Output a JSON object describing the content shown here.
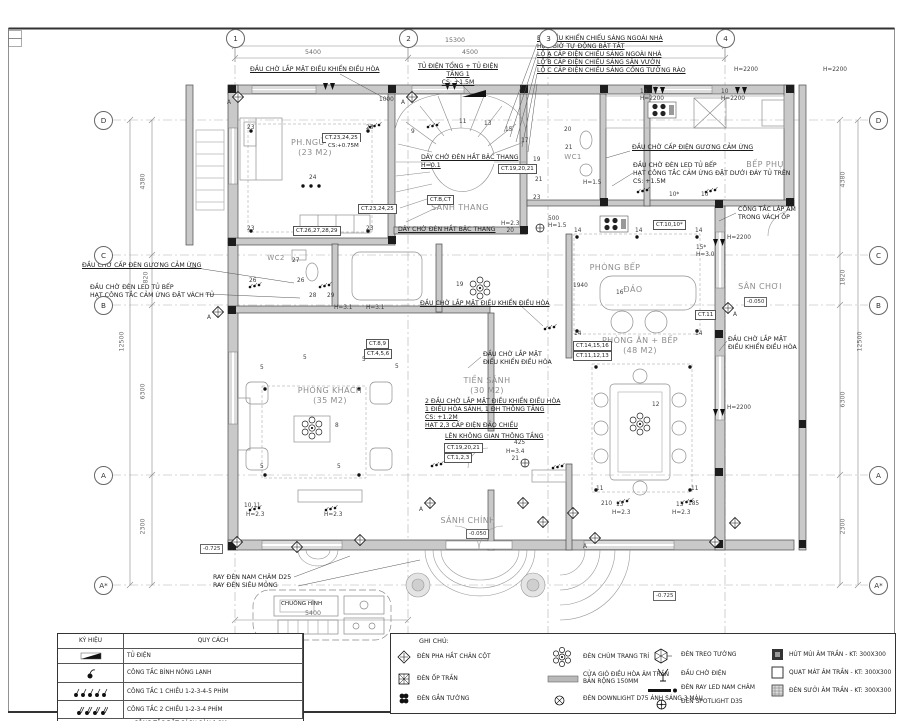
{
  "grid": {
    "top": [
      "1",
      "2",
      "3",
      "4"
    ],
    "bottom": [
      "1"
    ],
    "left": [
      "D",
      "C",
      "B",
      "A",
      "A*"
    ],
    "right": [
      "D",
      "C",
      "B",
      "A",
      "A*"
    ]
  },
  "dims": {
    "top_total": "15300",
    "top_segs": [
      "5400",
      "4500"
    ],
    "bottom": "5400",
    "left": [
      "4380",
      "820",
      "12500",
      "6300",
      "2300"
    ],
    "right": [
      "4380",
      "1820",
      "12500",
      "6300",
      "2300"
    ]
  },
  "rooms": {
    "bedroom": "PH.NGỦ-01\n(23 M2)",
    "stair_hall": "SẢNH THANG",
    "wc1": "WC1",
    "wc2": "WC2",
    "kitchen_aux": "BẾP PHỤ",
    "kitchen": "PHÒNG BẾP",
    "island": "ĐẢO",
    "playground": "SÂN CHƠI",
    "dining": "PHÒNG ĂN + BẾP\n(48 M2)",
    "living": "PHÒNG KHÁCH\n(35 M2)",
    "foyer": "TIỀN SẢNH\n(30 M2)",
    "main_hall": "SẢNH CHÍNH"
  },
  "callouts": {
    "ac_top": "ĐẦU CHỜ LẮP MẶT ĐIỀU KHIỂN ĐIỀU HÒA",
    "panel": "TỦ ĐIỆN TỔNG + TỦ ĐIỆN TẦNG 1\nCS: +1.5M",
    "lighting_ctrl": "BỘ ĐIỀU KHIỂN CHIẾU SÁNG NGOÀI NHÀ\nHẸN GIỜ TỰ ĐỘNG BẬT TẮT\nLỘ A CẤP ĐIỆN CHIẾU SÁNG NGOÀI NHÀ\nLỘ B CẤP ĐIỆN CHIẾU SÁNG SÂN VƯỜN\nLỘ C CẤP ĐIỆN CHIẾU SÁNG CỔNG TƯỜNG RÀO",
    "mirror_left": "ĐẦU CHỜ CẤP ĐÈN GƯƠNG CẢM ỨNG",
    "led_left": "ĐẦU CHỜ ĐÈN LED TỦ BẾP\nHẠT CÔNG TẮC CẢM ỨNG ĐẶT VÁCH TỦ",
    "mirror_right": "ĐẦU CHỜ CẤP ĐIỆN GƯƠNG CẢM ỨNG",
    "led_right": "ĐẦU CHỜ ĐÈN LED TỦ BẾP\nHẠT CÔNG TẮC CẢM ỨNG ĐẶT DƯỚI ĐÁY TỦ TRÊN\nCS: +1.5M",
    "flush_switch": "CÔNG TẮC LẬP ÂM\nTRONG VÁCH ỐP",
    "stair_strip_top": "DÂY CHỜ ĐÈN HẮT BẬC THANG\nH=0.1",
    "stair_strip_bottom": "DÂY CHỜ ĐÈN HẮT BẬC THANG",
    "ac_mid": "ĐẦU CHỜ LẮP MẶT ĐIỀU KHIỂN ĐIỀU HÒA",
    "ac_foyer": "ĐẦU CHỜ LẮP MẶT\nĐIỀU KHIỂN ĐIỀU HÒA",
    "ac_right": "ĐẦU CHỜ LẮP MẶT\nĐIỀU KHIỂN ĐIỀU HÒA",
    "foyer_block": "2 ĐẦU CHỜ LẮP MẶT ĐIỀU KHIỂN ĐIỀU HÒA\n1 ĐIỀU HÒA SẢNH, 1 ĐH THÔNG TẦNG\nCS: +1.2M\nHẠT 2,3 CẤP ĐIỆN ĐẢO CHIỀU",
    "void_up": "LÊN KHÔNG GIAN THÔNG TẦNG",
    "ray_d25": "RAY ĐÈN NAM CHÂM D25\nRAY ĐÈN SIÊU MỎNG",
    "doorbell": "CHUÔNG HÌNH"
  },
  "ct": {
    "b1": "CT.23,24,25",
    "b1s": "CS:+0.75M",
    "b2": "CT.26,27,28,29",
    "b3": "CT.23,24,25",
    "b4": "CT.19,20,21",
    "b5": "CT.B,CT",
    "b6": "CT.8,9",
    "b7": "CT.4,5,6",
    "b8": "CT.19,20,21",
    "b9": "CT.1,2,3",
    "b10": "CT.14,15,16",
    "b11": "CT.11,12,13",
    "b12": "CT.10,10*",
    "b13": "CT.11"
  },
  "levels": {
    "hall": "-0.050",
    "play": "-0.050",
    "porch1": "-0.725",
    "porch2": "-0.725"
  },
  "marks": [
    "23",
    "23",
    "24",
    "23",
    "23",
    "9",
    "11",
    "13",
    "15",
    "17",
    "19",
    "21",
    "23",
    "20",
    "21",
    "27",
    "26",
    "26",
    "28",
    "29",
    "14",
    "14",
    "14",
    "16",
    "14",
    "14",
    "5",
    "5",
    "5",
    "5",
    "5",
    "5",
    "8",
    "19",
    "12",
    "11",
    "11",
    "10,11",
    "H=2.3",
    "H=2.3",
    "13",
    "H=2.3",
    "13",
    "H=2.3",
    "H=3.1",
    "H=3.1",
    "H=2.3\n20",
    "H=3.4\n21",
    "425",
    "210",
    "185",
    "500\nH=1.5",
    "10\nH=2200",
    "10\nH=2200",
    "H=2200",
    "H=2200",
    "H=2200",
    "H=2200",
    "10*",
    "10",
    "1000",
    "1940",
    "15*\nH=3.0",
    "A",
    "A",
    "A",
    "A",
    "A",
    "A",
    "H=1.5"
  ],
  "legend": {
    "headers": [
      "KÝ HIỆU",
      "QUY CÁCH"
    ],
    "rows": [
      {
        "icon": "distribution-board-icon",
        "label": "TỦ ĐIỆN"
      },
      {
        "icon": "water-heater-switch-icon",
        "label": "CÔNG TẮC BÌNH NÓNG LẠNH"
      },
      {
        "icon": "switch-1way-icon",
        "label": "CÔNG TẮC 1 CHIỀU 1-2-3-4-5 PHÍM"
      },
      {
        "icon": "switch-2way-icon",
        "label": "CÔNG TẮC 2 CHIỀU 1-2-3-4 PHÍM"
      }
    ],
    "footer": "CÔNG TẮC ĐẶT CÁCH SÀN 1.2M"
  },
  "notes": {
    "title": "GHI CHÚ:",
    "col1": [
      {
        "icon": "accent-light-icon",
        "label": "ĐÈN PHA HẮT CHÂN CỘT"
      },
      {
        "icon": "ceiling-light-icon",
        "label": "ĐÈN ỐP TRẦN"
      },
      {
        "icon": "wall-light-icon",
        "label": "ĐÈN GẮN TƯỜNG"
      }
    ],
    "col2": [
      {
        "icon": "chandelier-icon",
        "label": "ĐÈN CHÙM TRANG TRÍ"
      },
      {
        "icon": "ac-vent-icon",
        "label": "CỬA GIÓ ĐIỀU HÒA ÂM TRẦN\nBẢN RỘNG 150MM"
      },
      {
        "icon": "downlight-icon",
        "label": "ĐÈN DOWNLIGHT D75 ÁNH SÁNG 3 MÀU"
      }
    ],
    "col3": [
      {
        "icon": "wall-pendant-icon",
        "label": "ĐÈN TREO TƯỜNG"
      },
      {
        "icon": "power-stub-icon",
        "label": "ĐẦU CHỜ ĐIỆN"
      },
      {
        "icon": "magnetic-track-icon",
        "label": "ĐÈN RAY LED NAM CHÂM"
      },
      {
        "icon": "spotlight-icon",
        "label": "ĐÈN SPOTLIGHT D35"
      }
    ],
    "col4": [
      {
        "icon": "exhaust-fan-icon",
        "label": "HÚT MÙI ÂM TRẦN - KT: 300X300"
      },
      {
        "icon": "cooling-fan-icon",
        "label": "QUẠT MÁT ÂM TRẦN - KT: 300X300"
      },
      {
        "icon": "heat-lamp-icon",
        "label": "ĐÈN SƯỞI ÂM TRẦN - KT: 300X300"
      }
    ]
  }
}
